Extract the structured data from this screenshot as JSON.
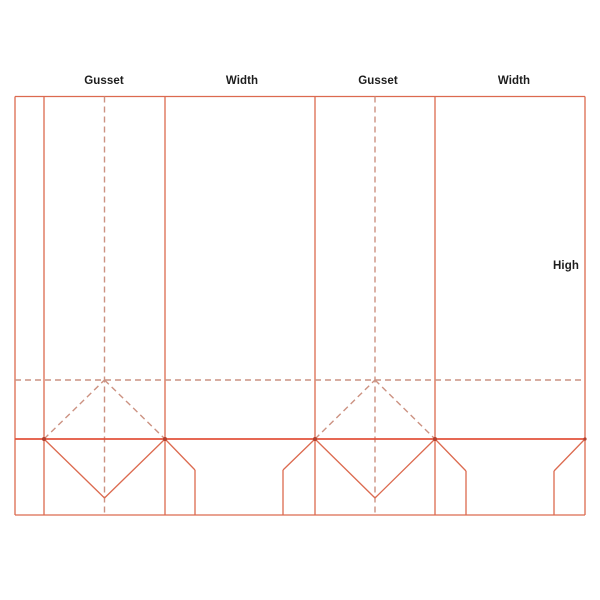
{
  "diagram": {
    "type": "packaging-dieline-bag-template",
    "labels": {
      "gusset_1": "Gusset",
      "width_1": "Width",
      "gusset_2": "Gusset",
      "width_2": "Width",
      "high": "High"
    },
    "colors": {
      "solid_line": "#dc6a4f",
      "fold_line": "#e2523c",
      "dashed_line": "#cc9282",
      "junction_dot": "#b2402e",
      "label_text": "#1d1d1d",
      "background": "#ffffff"
    }
  }
}
